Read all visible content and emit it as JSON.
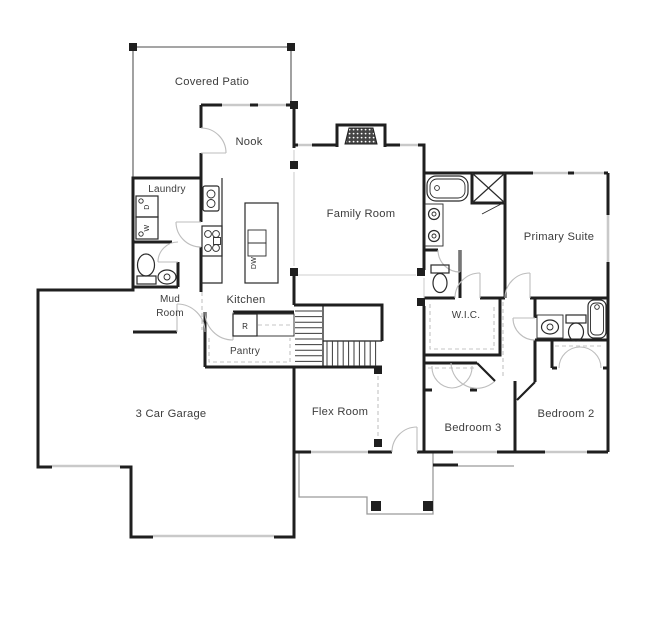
{
  "drawing": {
    "type": "residential-floor-plan",
    "colors": {
      "background": "#ffffff",
      "wall": "#1f1f1f",
      "window": "#c9c9c9",
      "door_arc": "#bdbdbd",
      "dashed_shelf": "#c4c4c4",
      "porch_outline": "#9a9a9a",
      "label_text": "#3c3c3c"
    },
    "rooms": {
      "covered_patio": "Covered Patio",
      "nook": "Nook",
      "laundry": "Laundry",
      "family_room": "Family Room",
      "primary_suite": "Primary Suite",
      "mud_room_line1": "Mud",
      "mud_room_line2": "Room",
      "kitchen": "Kitchen",
      "wic": "W.I.C.",
      "pantry": "Pantry",
      "garage": "3 Car Garage",
      "flex_room": "Flex Room",
      "bedroom3": "Bedroom 3",
      "bedroom2": "Bedroom 2"
    },
    "appliances": {
      "dryer": "D",
      "washer": "W",
      "refrigerator": "R",
      "dishwasher": "DW"
    }
  }
}
